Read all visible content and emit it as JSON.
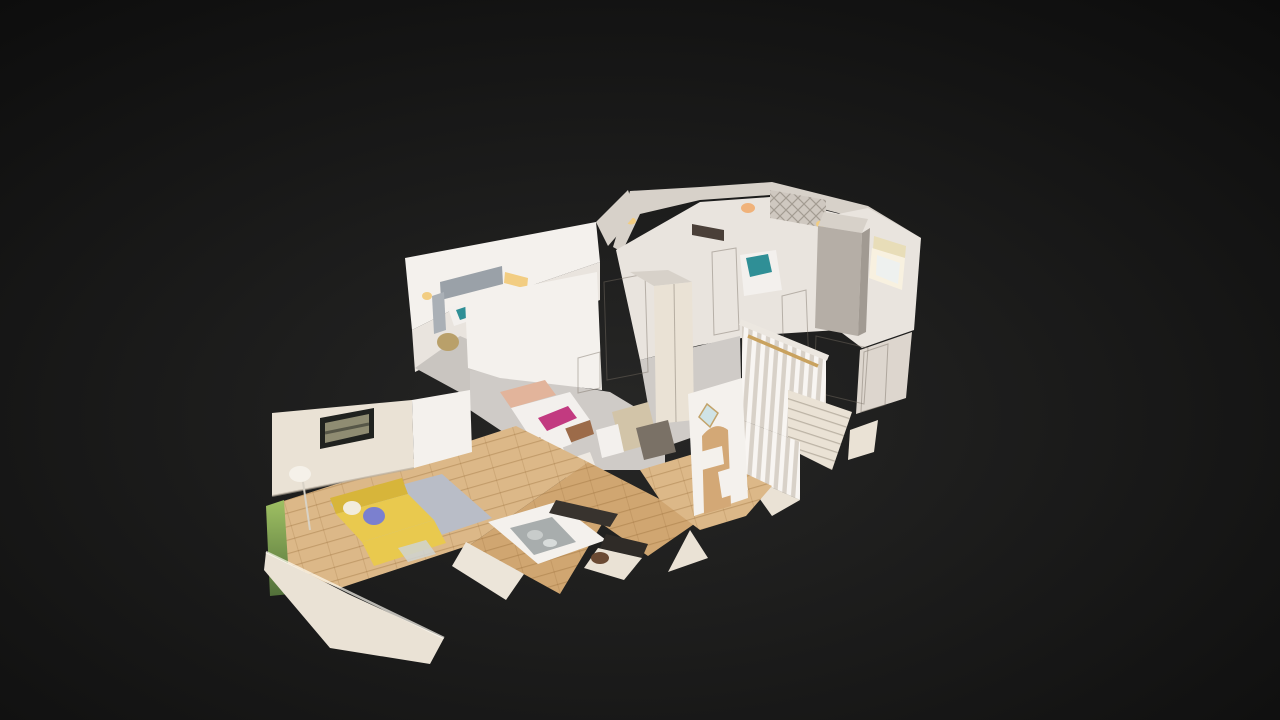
{
  "viewer": {
    "mode": "dollhouse-3d-view",
    "description": "Cutaway 3D dollhouse scan of a two-storey home interior floating on a dark backdrop, viewed from above at an oblique angle"
  },
  "background": {
    "center": "#272726",
    "edge": "#0c0c0c"
  },
  "model": {
    "colors": {
      "wall_bright": "#f4f1ed",
      "wall_mid": "#e9e4de",
      "wall_dim": "#ddd6ce",
      "wall_top": "#d7d1c9",
      "wall_cut": "#eae2d5",
      "wall_shadow": "#cfc8c0",
      "floor_wood": "#dcb888",
      "floor_wood_dark": "#d0a671",
      "carpet": "#cfcbc7",
      "carpet_dim": "#c6c2bd",
      "rug": "#b9bdc7",
      "sofa": "#e9c94e",
      "sofa_shade": "#d7b53a",
      "cushion_blue": "#7b80cf",
      "bed_linen": "#f3f0ed",
      "bed_accent_pink": "#c23a80",
      "pillow_peach": "#e2b49b",
      "bed_frame_wood": "#9c6b49",
      "teal_bed": "#2f8f96",
      "artwork_frame": "#20221f",
      "artwork_canvas": "#8f8c72",
      "sconce_glow": "#f2cd82",
      "window_glow": "#f8f1e0",
      "window_sky": "#eef1ef",
      "blind_cream": "#e8ddb8",
      "worktop_dark": "#38332e",
      "hob_black": "#2f2b27",
      "sink_steel": "#a8adad",
      "plant_light": "#9fc063",
      "plant_dark": "#52703a",
      "handrail_wood": "#c9a25f",
      "balustrade": "#d8d1c8",
      "wardrobe_gray": "#b5aea6",
      "curtain_gray": "#9aa1a8",
      "arch_interior": "#d3a876",
      "mirror_glass": "#cfe3e6",
      "basket_wicker": "#b9a06a",
      "headboard_dark": "#4a3f38",
      "lamp_warm": "#f0b27a",
      "leather_bag": "#6b4a33",
      "chair_tan": "#d2c4a8",
      "table_dark": "#7a7166"
    },
    "rooms": [
      {
        "id": "living-room",
        "label": "Living room",
        "features": "yellow corner sofa, blue cushion, framed artwork, floor lamp, grey rug, timber floor"
      },
      {
        "id": "bedroom-main",
        "label": "Main bedroom",
        "features": "grey curtains, wall sconces, wicker basket, grey carpet"
      },
      {
        "id": "bedroom-pink",
        "label": "Bedroom with dressed bed",
        "features": "white duvet, pink throw, timber bed frame, fitted wardrobe, radiator"
      },
      {
        "id": "bedroom-teal",
        "label": "Bedroom with teal bed",
        "features": "teal bedding, lattice feature wall, warm lamp"
      },
      {
        "id": "kitchen",
        "label": "Kitchen",
        "features": "white units, dark worktop, inset steel sink, timber floor"
      },
      {
        "id": "hallway",
        "label": "Hallway",
        "features": "archway, wall mirror, console table"
      },
      {
        "id": "landing",
        "label": "Stair landing",
        "features": "white spindle balustrade, timber handrail, descending staircase"
      },
      {
        "id": "bathroom",
        "label": "Window bay / bathroom",
        "features": "bright window, cream blind, tall grey wardrobe"
      }
    ]
  }
}
